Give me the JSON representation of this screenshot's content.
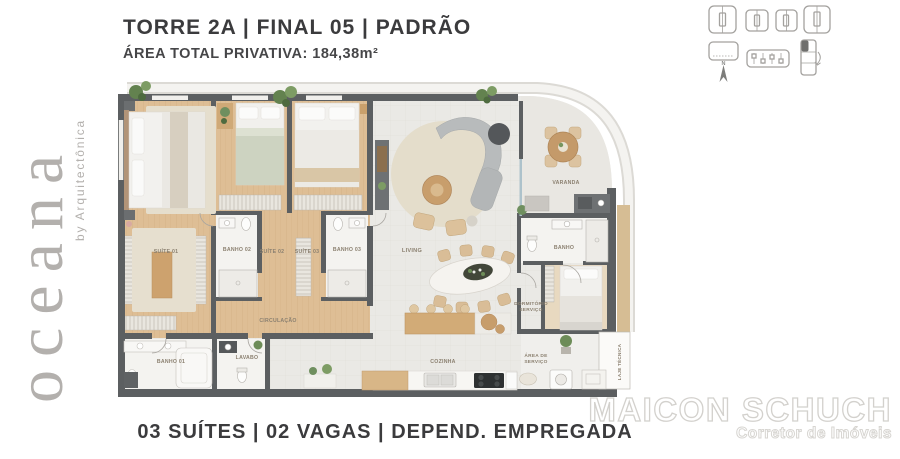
{
  "brand": {
    "logo_text": "oceana",
    "byline": "by Arquitectônica"
  },
  "header": {
    "title": "TORRE 2A | FINAL 05 | PADRÃO",
    "subtitle": "ÁREA TOTAL PRIVATIVA: 184,38m²"
  },
  "footer": {
    "features_line": "03 SUÍTES | 02 VAGAS | DEPEND. EMPREGADA"
  },
  "watermark": {
    "name": "MAICON SCHUCH",
    "role": "Corretor de Imóveis"
  },
  "floorplan": {
    "rooms": {
      "suite01": "SUÍTE 01",
      "suite02": "SUÍTE 02",
      "suite03": "SUÍTE 03",
      "banho01": "BANHO 01",
      "banho02": "BANHO 02",
      "banho03": "BANHO 03",
      "circulacao": "CIRCULAÇÃO",
      "living": "LIVING",
      "varanda": "VARANDA",
      "cozinha": "COZINHA",
      "lavabo": "LAVABO",
      "banho_servico": "BANHO",
      "dormitorio_servico_l1": "DORMITÓRIO",
      "dormitorio_servico_l2": "SERVIÇO",
      "area_servico_l1": "ÁREA DE",
      "area_servico_l2": "SERVIÇO",
      "laje_tecnica": "LAJE TÉCNICA"
    },
    "colors": {
      "wall": "#5c5f61",
      "wood_floor": "#debe95",
      "tile": "#f4f3f0",
      "living_floor": "#eae9e5",
      "accent_wood": "#c79d6b",
      "label_text": "#8b8070",
      "logo_gray": "#b3b0ad"
    }
  },
  "icons": {
    "row1": [
      "keyplan-wide-icon",
      "keyplan-small-icon",
      "keyplan-small-icon-2",
      "keyplan-wide-icon-2"
    ],
    "row2": [
      "north-compass-icon",
      "levels-icon",
      "unit-position-icon"
    ]
  }
}
